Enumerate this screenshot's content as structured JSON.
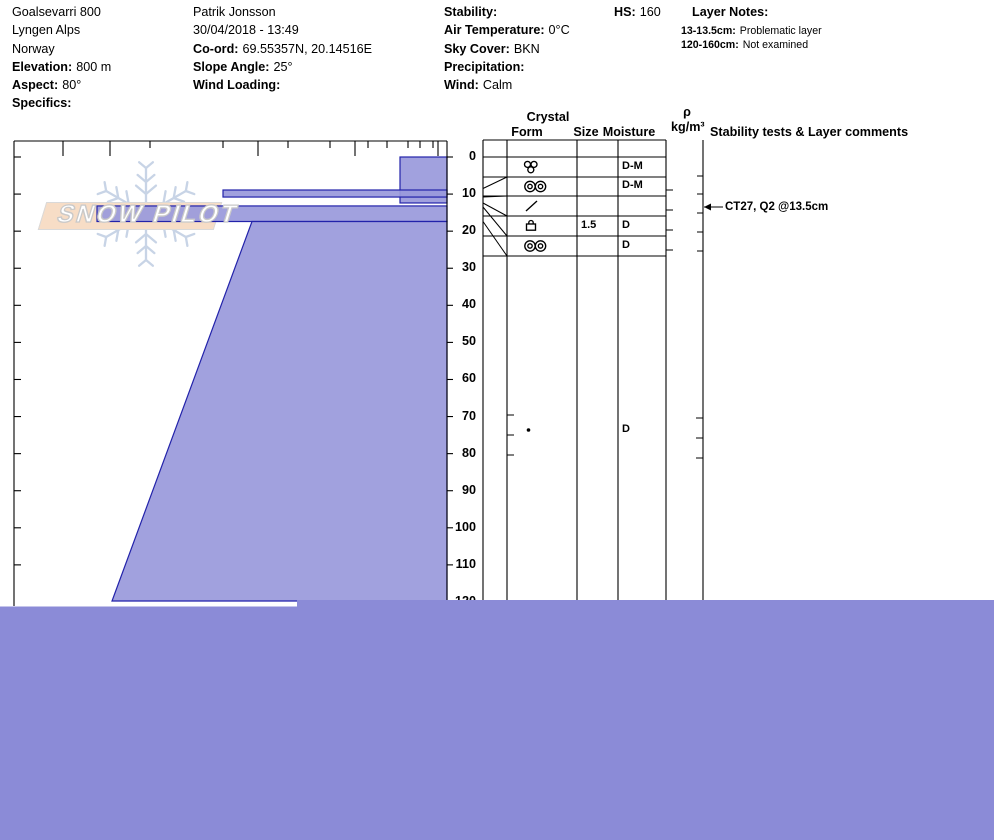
{
  "header": {
    "col1": [
      {
        "label": "",
        "value": "Goalsevarri 800"
      },
      {
        "label": "",
        "value": "Lyngen Alps"
      },
      {
        "label": "",
        "value": "Norway"
      },
      {
        "label": "Elevation:",
        "value": "800 m"
      },
      {
        "label": "Aspect:",
        "value": "80°"
      },
      {
        "label": "Specifics:",
        "value": ""
      }
    ],
    "col2": [
      {
        "label": "",
        "value": "Patrik Jonsson"
      },
      {
        "label": "",
        "value": "30/04/2018 - 13:49"
      },
      {
        "label": "Co-ord:",
        "value": "69.55357N, 20.14516E"
      },
      {
        "label": "Slope Angle:",
        "value": "25°"
      },
      {
        "label": "Wind Loading:",
        "value": ""
      }
    ],
    "col3": [
      {
        "label": "Stability:",
        "value": ""
      },
      {
        "label": "Air Temperature:",
        "value": "0°C"
      },
      {
        "label": "Sky Cover:",
        "value": "BKN"
      },
      {
        "label": "Precipitation:",
        "value": ""
      },
      {
        "label": "Wind:",
        "value": "Calm"
      }
    ],
    "hs": {
      "label": "HS:",
      "value": "160"
    },
    "layer_notes": {
      "title": "Layer Notes:",
      "items": [
        {
          "range": "13-13.5cm:",
          "note": "Problematic layer"
        },
        {
          "range": "120-160cm:",
          "note": "Not examined"
        }
      ]
    }
  },
  "table": {
    "headers": {
      "crystal": "Crystal",
      "form": "Form",
      "size": "Size",
      "moisture": "Moisture",
      "rho": "ρ",
      "rho_unit": "kg/m³",
      "comments": "Stability tests & Layer comments"
    },
    "rows": [
      {
        "form": "",
        "size": "",
        "moisture": ""
      },
      {
        "form": "clustered-grains",
        "size": "",
        "moisture": "D-M"
      },
      {
        "form": "double-rings",
        "size": "",
        "moisture": "D-M"
      },
      {
        "form": "slash",
        "size": "",
        "moisture": ""
      },
      {
        "form": "crust",
        "size": "1.5",
        "moisture": "D"
      },
      {
        "form": "double-rings",
        "size": "",
        "moisture": "D"
      }
    ],
    "deep_row": {
      "form": "dot",
      "size": "",
      "moisture": "D"
    },
    "comment": "CT27, Q2 @13.5cm"
  },
  "logo": {
    "text": "SNOW PILOT"
  },
  "colors": {
    "layer_fill": "#9a9adc",
    "layer_border": "#2222aa",
    "not_examined_fill": "#8b8bd7",
    "banner_fill": "#f7ddc6",
    "snowflake": "#c8d4e6"
  },
  "chart_data": {
    "type": "bar",
    "subtype": "snow-hardness-profile",
    "title": "Snow pit hardness profile",
    "depth_axis": {
      "unit": "cm",
      "min": 0,
      "max": 160,
      "label_interval": 10,
      "labels": [
        0,
        10,
        20,
        30,
        40,
        50,
        60,
        70,
        80,
        90,
        100,
        110,
        120
      ]
    },
    "hs_cm": 160,
    "layers": [
      {
        "from_cm": 0,
        "to_cm": 12.4,
        "hardness": "F",
        "grain": "clustered-grains",
        "moisture": "D-M"
      },
      {
        "from_cm": 8.9,
        "to_cm": 10.8,
        "hardness": "1F",
        "grain": "double-rings",
        "moisture": "D-M"
      },
      {
        "from_cm": 13.0,
        "to_cm": 13.5,
        "hardness": "",
        "grain": "slash",
        "moisture": "",
        "note": "Problematic layer"
      },
      {
        "from_cm": 13.2,
        "to_cm": 17.4,
        "hardness": "K",
        "grain": "crust",
        "size_mm": 1.5,
        "moisture": "D"
      },
      {
        "from_cm": 17.5,
        "to_cm": 120,
        "hardness": "P to K (ramp)",
        "grain": "dot (rounded grains)",
        "moisture": "D"
      },
      {
        "from_cm": 120,
        "to_cm": 160,
        "hardness": "not examined"
      }
    ],
    "stability_tests": [
      {
        "test": "CT27, Q2 @13.5cm",
        "depth_cm": 13.5
      }
    ],
    "render_px": {
      "y0": 157,
      "px_per_cm": 3.708,
      "x_left": 14,
      "x_right": 447,
      "y_top": 141,
      "bars": [
        {
          "left": 400,
          "from_cm": 0,
          "to_cm": 12.4
        },
        {
          "left": 223,
          "from_cm": 8.9,
          "to_cm": 10.8
        },
        {
          "left": 97,
          "from_cm": 13.2,
          "to_cm": 17.4
        }
      ],
      "ramp": {
        "left_top": 252,
        "top_y": 221.5,
        "left_bottom": 112,
        "bottom_y": 601
      },
      "blocks": [
        [
          297,
          600,
          697,
          240
        ],
        [
          0,
          606.5,
          994,
          233.5
        ]
      ],
      "top_ticks_major": [
        63,
        110,
        258,
        355,
        438
      ],
      "top_ticks_minor": [
        150,
        223,
        288,
        330,
        368,
        387,
        408,
        420,
        433
      ],
      "depth_tick_count": 12,
      "table_cols": [
        483,
        507,
        577,
        618,
        666,
        703
      ],
      "row_bounds": [
        157,
        177,
        196,
        216,
        236,
        256
      ],
      "grid_top": 140,
      "grid_bottom": 600,
      "leaders": [
        [
          188.5,
          177
        ],
        [
          197,
          196
        ],
        [
          203,
          216
        ],
        [
          207,
          236
        ],
        [
          221.5,
          256
        ]
      ],
      "right_dashes": [
        190,
        210,
        230,
        250
      ],
      "comment_ticks": [
        176,
        194,
        213,
        232,
        251
      ],
      "deep_ticks_left": [
        415,
        435,
        455
      ],
      "deep_ticks_right": [
        418,
        438,
        458
      ],
      "symbol_x": 524,
      "deep_row_y": 430,
      "arrow_y": 207
    }
  }
}
